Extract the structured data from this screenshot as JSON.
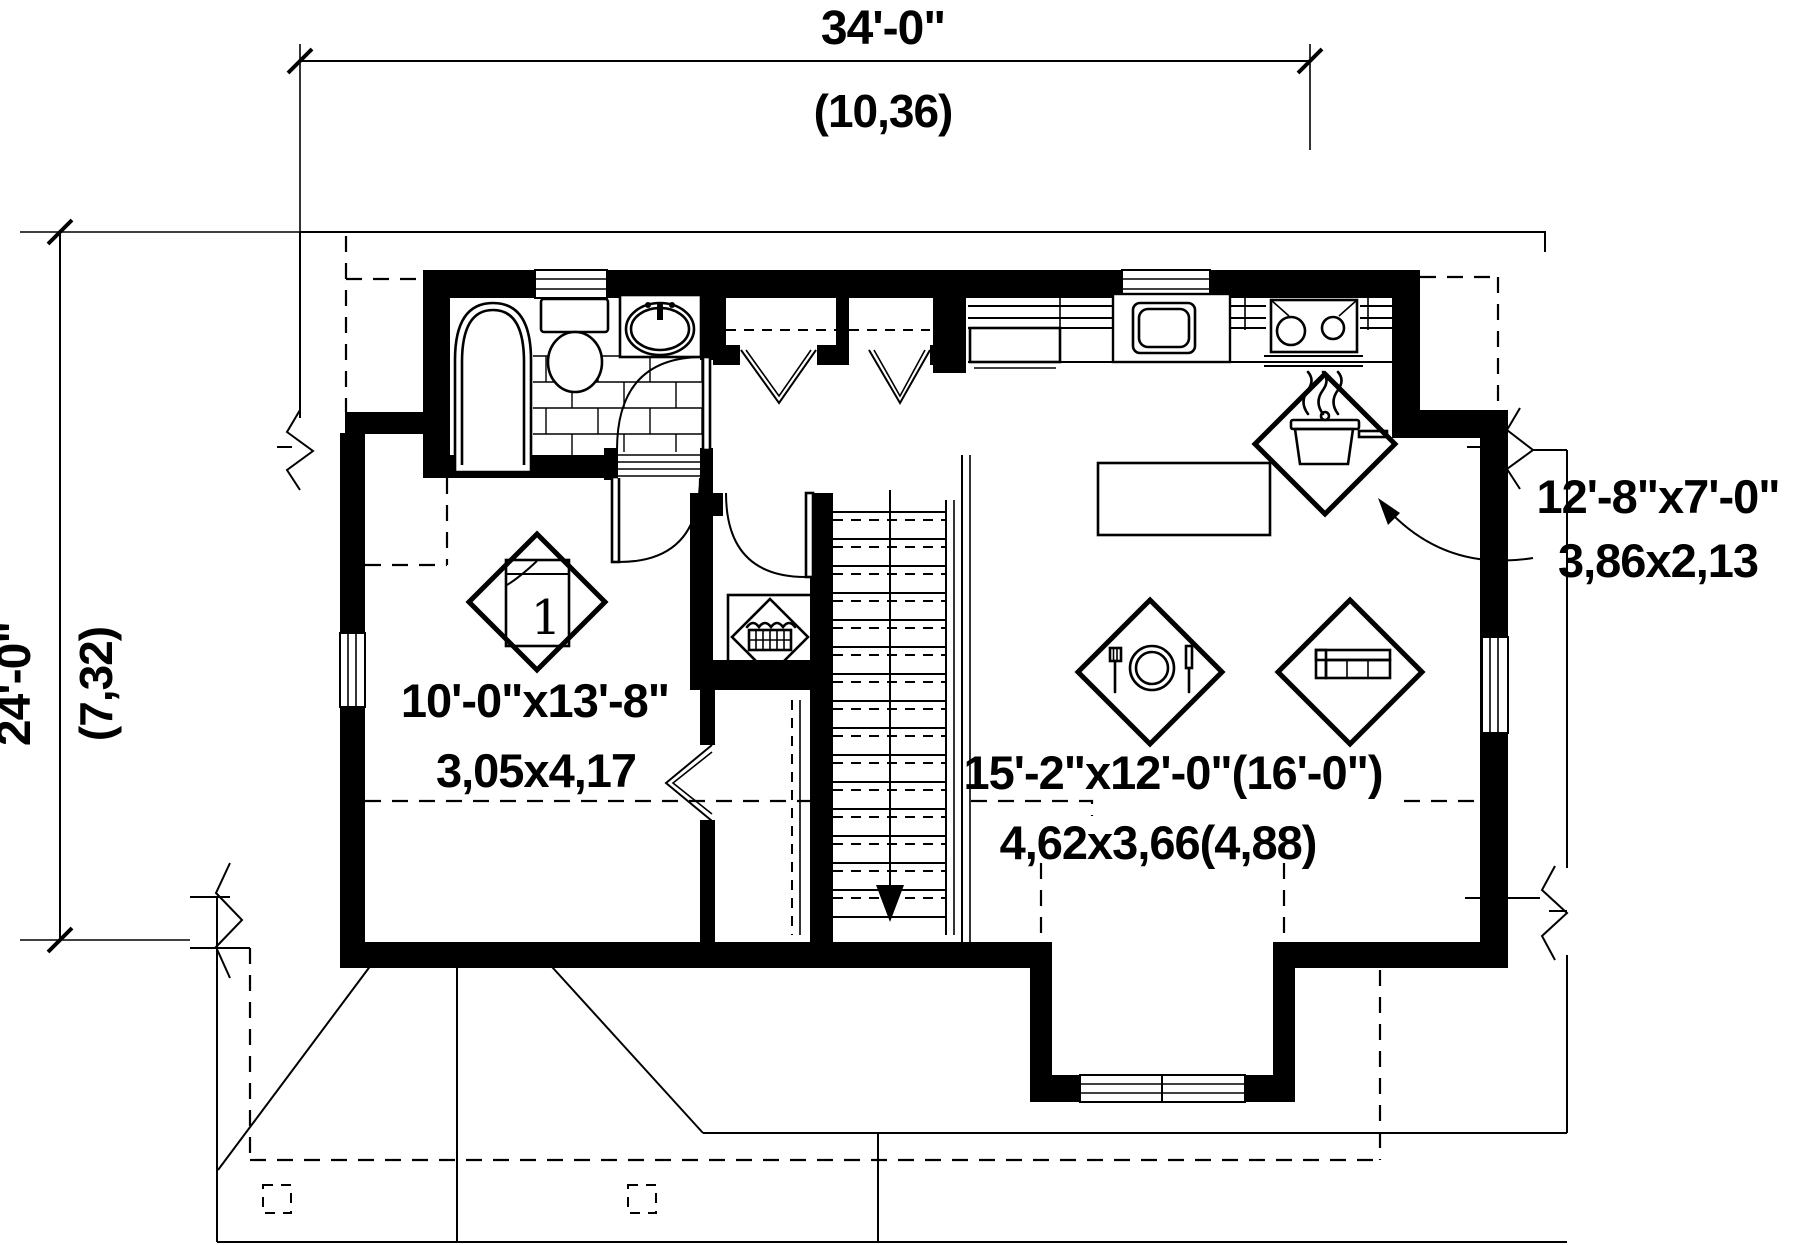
{
  "drawing_type": "floor-plan",
  "dimensions": {
    "overall_width": {
      "feet": "34'-0\"",
      "meters": "(10,36)"
    },
    "overall_depth": {
      "feet": "24'-0\"",
      "meters": "(7,32)"
    }
  },
  "rooms": {
    "bedroom": {
      "feet": "10'-0\"x13'-8\"",
      "meters": "3,05x4,17",
      "number": "1"
    },
    "living_dining": {
      "feet": "15'-2\"x12'-0\"(16'-0\")",
      "meters": "4,62x3,66(4,88)"
    },
    "kitchen": {
      "feet": "12'-8\"x7'-0\"",
      "meters": "3,86x2,13"
    }
  },
  "icons": {
    "bedroom": "bed-icon",
    "kitchen": "cooking-pot-icon",
    "dining": "dining-plate-icon",
    "living": "sofa-icon",
    "laundry": "laundry-basket-icon"
  },
  "colors": {
    "line": "#000000",
    "background": "#ffffff"
  }
}
